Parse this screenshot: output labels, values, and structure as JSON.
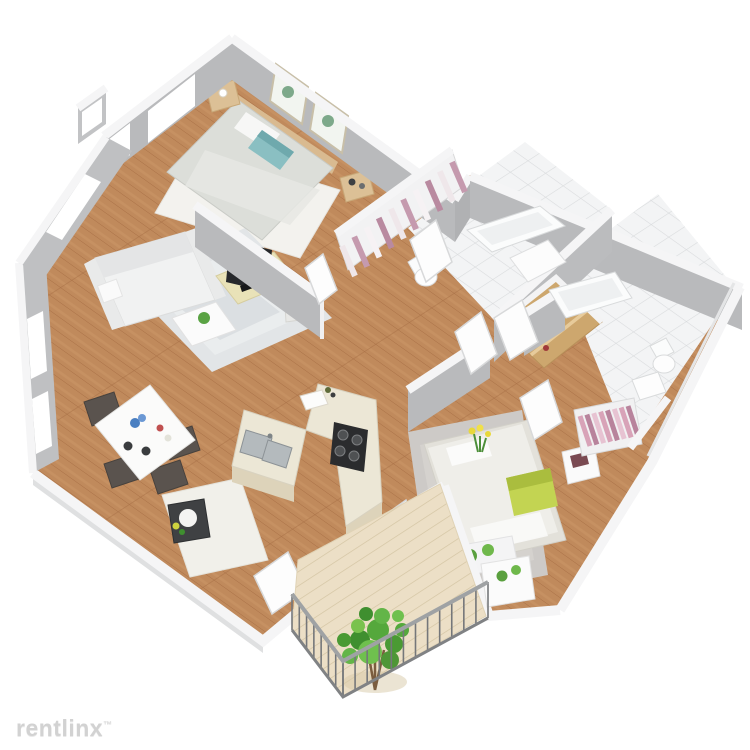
{
  "watermark": {
    "brand": "rentlinx",
    "trademark_symbol": "™"
  },
  "palette": {
    "background": "#ffffff",
    "wall_face": "#b9babc",
    "wall_cap": "#f5f5f6",
    "wood_floor": "#c08a5c",
    "tile_floor": "#f3f4f5",
    "deck": "#ecdfc6",
    "accent_teal_pillow": "#8abfc2",
    "accent_green_pillow": "#c3d452",
    "plant_green": "#5aa03e",
    "clothes_pink": "#c98fa8",
    "tv_console": "#e9e2b8",
    "watermark_gray": "#d2d2d2"
  },
  "scene": {
    "type": "3d-isometric-floor-plan",
    "rooms": [
      {
        "name": "Bedroom 1",
        "items": [
          "double bed with teal pillow",
          "two wood nightstands",
          "two cactus wall prints",
          "white rug",
          "windows"
        ]
      },
      {
        "name": "Living Room",
        "items": [
          "white sofa",
          "coffee table with plant",
          "TV on wood media console",
          "gray area rug",
          "potted plant",
          "window"
        ]
      },
      {
        "name": "Dining Area",
        "items": [
          "white dining table",
          "four dark chairs",
          "table decor",
          "windows",
          "serving tray table",
          "entry rug"
        ]
      },
      {
        "name": "Kitchen",
        "items": [
          "L-shaped counter",
          "double stainless sink",
          "4-burner stove",
          "cutting board"
        ]
      },
      {
        "name": "Bathroom 1",
        "items": [
          "bathtub",
          "toilet",
          "white tile floor",
          "door"
        ]
      },
      {
        "name": "Linen Closet",
        "items": [
          "shelves with folded striped linens"
        ]
      },
      {
        "name": "Hall Closet",
        "items": [
          "wooden shelves"
        ]
      },
      {
        "name": "Bathroom 2",
        "items": [
          "bathtub",
          "toilet",
          "sink",
          "white tile floor"
        ]
      },
      {
        "name": "Bedroom 2",
        "items": [
          "bed with green pillow and flowers",
          "nightstand with book",
          "wardrobe with pink clothes",
          "gray shag rug",
          "bench with potted plants"
        ]
      },
      {
        "name": "Balcony",
        "items": [
          "wood plank deck",
          "metal railing",
          "large potted plant",
          "planter box"
        ]
      }
    ]
  }
}
